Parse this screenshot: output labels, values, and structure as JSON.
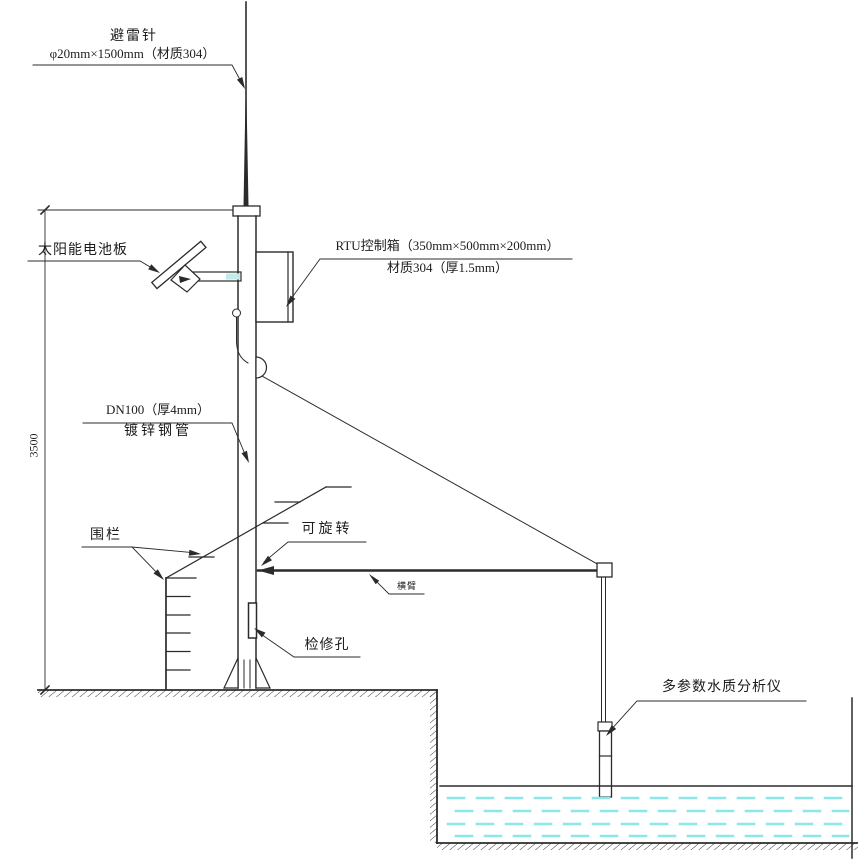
{
  "diagram": {
    "labels": {
      "lightning_rod_name": "避雷针",
      "lightning_rod_spec": "φ20mm×1500mm（材质304）",
      "solar_panel": "太阳能电池板",
      "rtu_box_spec": "RTU控制箱（350mm×500mm×200mm）",
      "rtu_box_material": "材质304（厚1.5mm）",
      "pipe_spec": "DN100（厚4mm）",
      "pipe_name": "镀锌钢管",
      "fence": "围栏",
      "rotatable": "可旋转",
      "boom": "横臂",
      "inspection_hole": "检修孔",
      "analyzer": "多参数水质分析仪",
      "height_dimension": "3500"
    },
    "colors": {
      "line": "#2b2b2b",
      "water_dash": "#8ce8e8",
      "bracket_accent": "#c2ecec"
    }
  }
}
